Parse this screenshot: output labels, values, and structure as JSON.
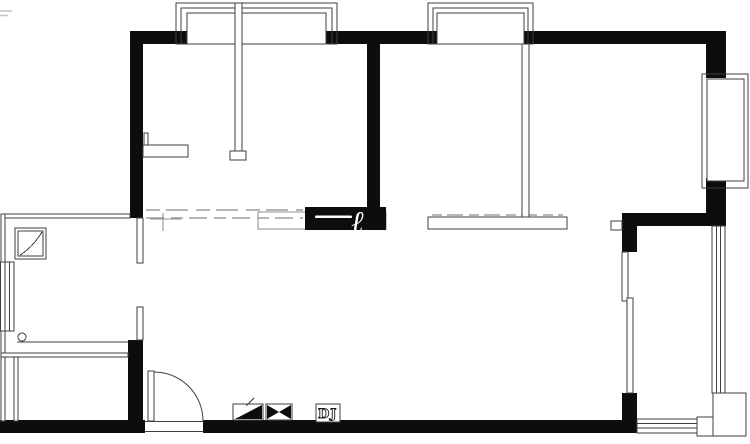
{
  "colors": {
    "background": "#ffffff",
    "wall": "#0d0d0d",
    "line": "#3f3f3f",
    "soft_line": "#8c8c8c",
    "dash": "#9e9e9e",
    "watermark": "#ffffff"
  },
  "labels": {
    "dj_box": "DJ",
    "watermark_glyph": "ℓ"
  },
  "plan": {
    "type": "floor-plan",
    "elements": [
      "exterior black walls",
      "bay window top-left with partition mullion",
      "bay window top-middle",
      "side bay window right",
      "left wall window",
      "corner cabinet in entry",
      "entry door with quarter-circle swing",
      "sliding door to balcony",
      "balcony side glazing with corner post and bottom sill",
      "interior wall stubs",
      "valve symbol",
      "check-valve (bowtie) symbol",
      "DJ shaft box",
      "white watermark stroke on wall"
    ]
  }
}
